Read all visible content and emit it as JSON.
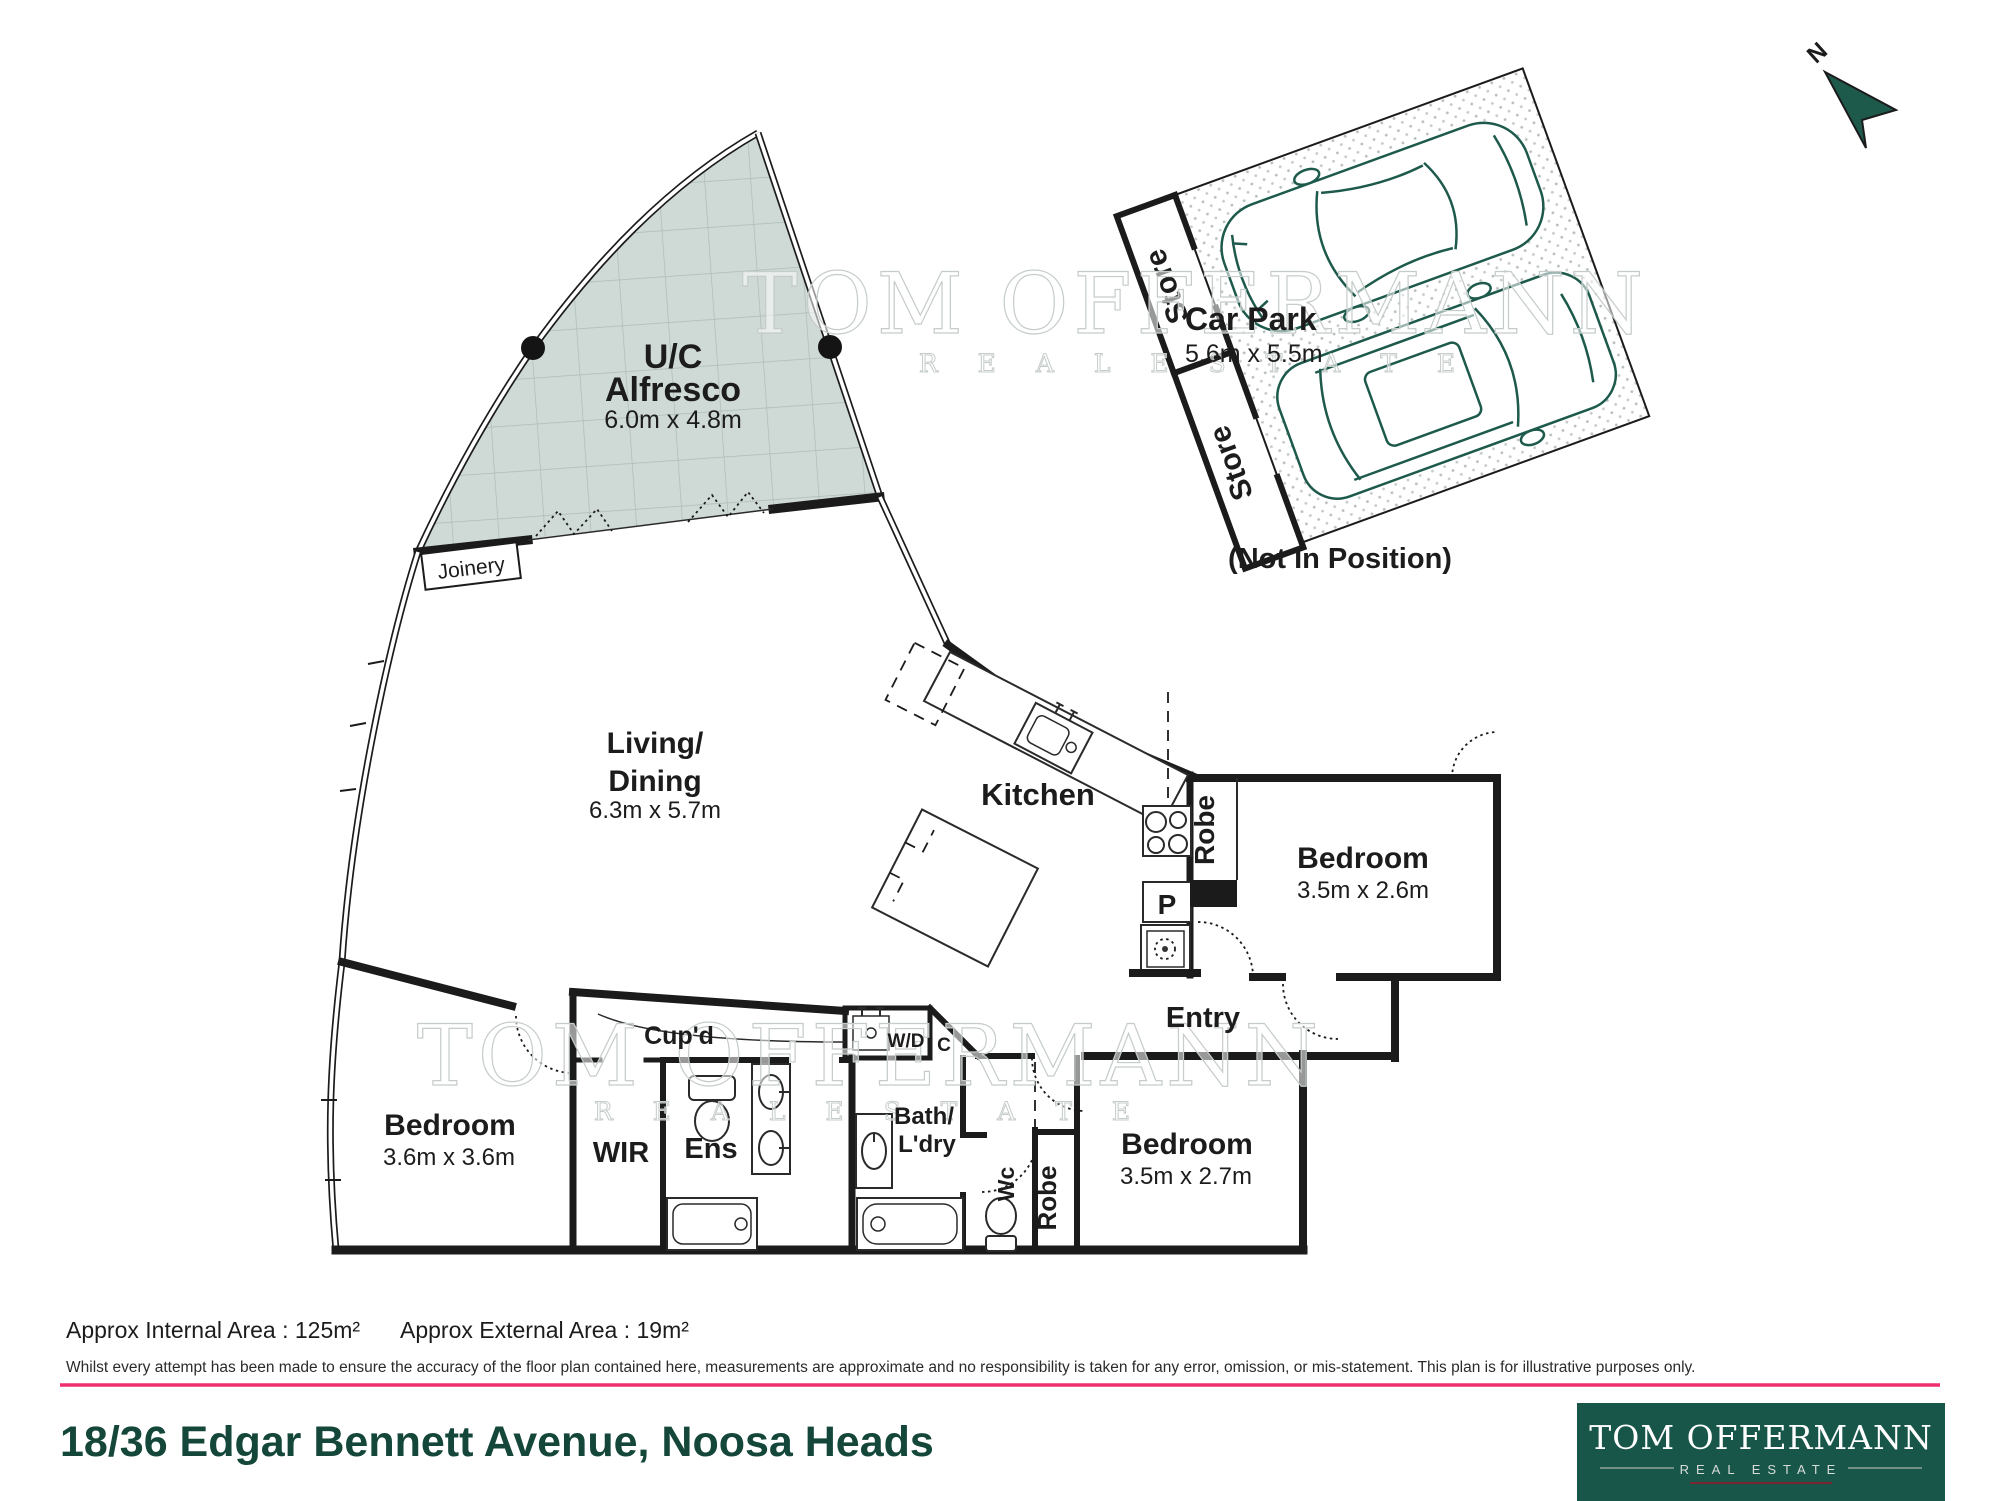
{
  "plan": {
    "north": "N",
    "alfresco": {
      "l1": "U/C",
      "l2": "Alfresco",
      "dims": "6.0m x 4.8m"
    },
    "joinery": "Joinery",
    "living": {
      "l1": "Living/",
      "l2": "Dining",
      "dims": "6.3m x 5.7m"
    },
    "kitchen": {
      "label": "Kitchen",
      "pantry": "P"
    },
    "carpark": {
      "label": "Car Park",
      "dims": "5.6m x 5.5m",
      "store_top": "Store",
      "store_bottom": "Store",
      "note": "(Not In Position)"
    },
    "bedroom_right": {
      "label": "Bedroom",
      "dims": "3.5m x 2.6m",
      "robe": "Robe"
    },
    "bedroom_left": {
      "label": "Bedroom",
      "dims": "3.6m x 3.6m"
    },
    "bedroom_bottom": {
      "label": "Bedroom",
      "dims": "3.5m x 2.7m",
      "robe": "Robe"
    },
    "entry": "Entry",
    "cupboard": "Cup'd",
    "wd": "W/D",
    "c": "C",
    "wir": "WIR",
    "ensuite": "Ens",
    "bath": {
      "l1": "Bath/",
      "l2": "L'dry"
    },
    "wc": "Wc"
  },
  "watermark": {
    "l1": "TOM OFFERMANN",
    "l2": "R E A L   E S T A T E"
  },
  "footer": {
    "area_internal": "Approx Internal Area : 125m²",
    "area_external": "Approx External Area : 19m²",
    "disclaimer": "Whilst every attempt has been made to ensure the accuracy of the floor plan contained here, measurements are approximate and no responsibility is taken for any error, omission, or mis-statement. This plan is for illustrative purposes only.",
    "address": "18/36 Edgar Bennett Avenue, Noosa Heads"
  },
  "logo": {
    "brand": "TOM OFFERMANN",
    "tagline": "REAL ESTATE"
  },
  "colors": {
    "accent_line": "#ED2F6E",
    "title_green": "#14463A",
    "logo_bg": "#19564A",
    "car_green": "#1D5A4C",
    "alfresco_fill": "#CFD9D5"
  }
}
